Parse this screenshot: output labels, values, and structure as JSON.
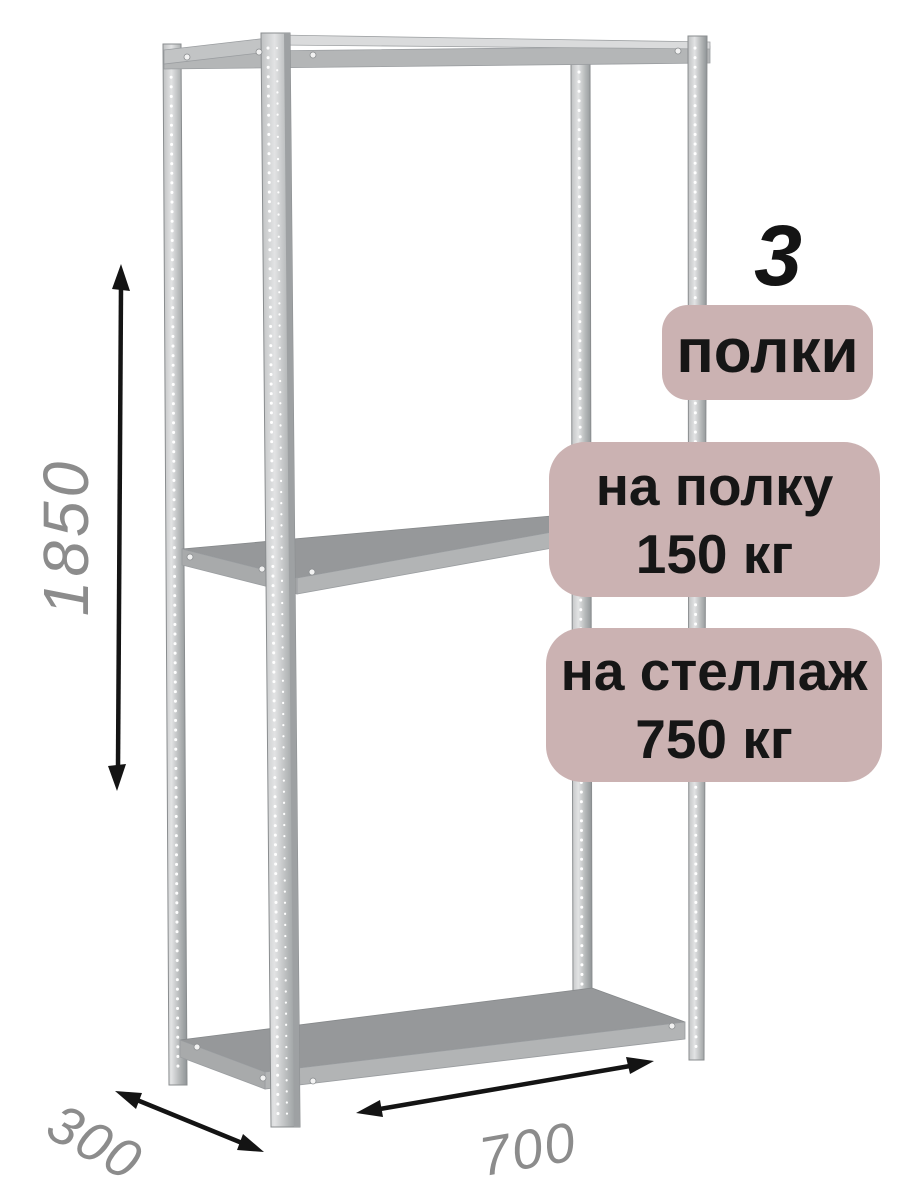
{
  "product": {
    "shelf_count": "3",
    "shelf_count_unit": "полки",
    "load_per_shelf": {
      "label": "на полку",
      "value": "150 кг"
    },
    "load_per_rack": {
      "label": "на стеллаж",
      "value": "750 кг"
    }
  },
  "dimensions": {
    "height": "1850",
    "depth": "300",
    "width": "700"
  },
  "colors": {
    "badge_background": "#cbb2b2",
    "badge_text": "#161616",
    "dimension_text": "#8c8c8c",
    "arrow": "#141414",
    "metal_light": "#e0e1e2",
    "metal_mid": "#b4b6b7",
    "metal_dark": "#96989a"
  },
  "icons": {
    "height_arrow": "double-headed-arrow-vertical",
    "depth_arrow": "double-headed-arrow-diagonal",
    "width_arrow": "double-headed-arrow-horizontal"
  }
}
